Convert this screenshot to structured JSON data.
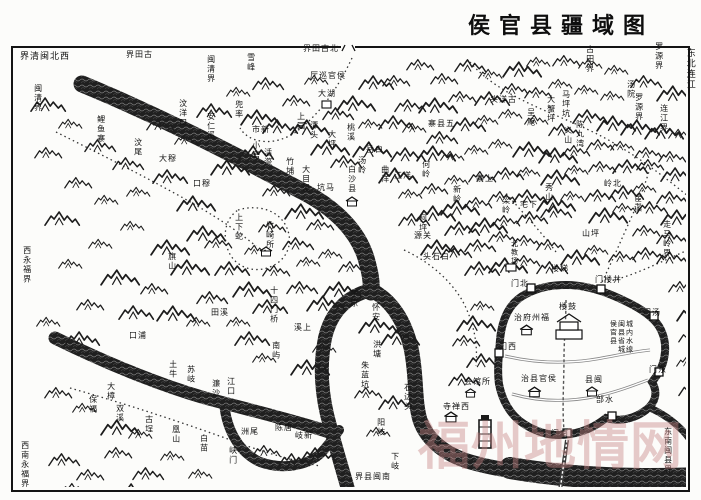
{
  "title": "侯官县疆域图",
  "watermark": "福州地情网",
  "colors": {
    "ink": "#1a1a1a",
    "paper": "#fcfcfa",
    "watermark": "rgba(197,131,131,0.42)"
  },
  "labels": [
    {
      "t": "界清闽北西",
      "x": 20,
      "y": 53,
      "o": "h",
      "fs": 9
    },
    {
      "t": "界田古",
      "x": 126,
      "y": 51,
      "o": "h"
    },
    {
      "t": "闽清界",
      "x": 206,
      "y": 55,
      "o": "v"
    },
    {
      "t": "界田古北",
      "x": 303,
      "y": 45,
      "o": "h"
    },
    {
      "t": "闽清界",
      "x": 33,
      "y": 84,
      "o": "v"
    },
    {
      "t": "古田界",
      "x": 585,
      "y": 45,
      "o": "v"
    },
    {
      "t": "罗源界",
      "x": 654,
      "y": 42,
      "o": "v"
    },
    {
      "t": "东北连江",
      "x": 684,
      "y": 48,
      "o": "v",
      "fs": 9
    },
    {
      "t": "罗源界",
      "x": 634,
      "y": 93,
      "o": "v"
    },
    {
      "t": "连江界",
      "x": 659,
      "y": 104,
      "o": "v"
    },
    {
      "t": "走马岭界",
      "x": 662,
      "y": 220,
      "o": "v"
    },
    {
      "t": "东南闽县界",
      "x": 663,
      "y": 427,
      "o": "v"
    },
    {
      "t": "西永福界",
      "x": 22,
      "y": 246,
      "o": "v"
    },
    {
      "t": "西南永福界",
      "x": 20,
      "y": 441,
      "o": "v"
    },
    {
      "t": "界县闽南",
      "x": 355,
      "y": 473,
      "o": "h"
    },
    {
      "t": "鲤鱼寨",
      "x": 96,
      "y": 115,
      "o": "v"
    },
    {
      "t": "汶尾",
      "x": 133,
      "y": 138,
      "o": "v"
    },
    {
      "t": "汶洋口",
      "x": 178,
      "y": 99,
      "o": "v"
    },
    {
      "t": "安仁溪",
      "x": 206,
      "y": 112,
      "o": "v"
    },
    {
      "t": "雪峰",
      "x": 246,
      "y": 53,
      "o": "v"
    },
    {
      "t": "厅巡官侯",
      "x": 310,
      "y": 72,
      "o": "h"
    },
    {
      "t": "大湖",
      "x": 318,
      "y": 90,
      "o": "h"
    },
    {
      "t": "兜率",
      "x": 234,
      "y": 100,
      "o": "v"
    },
    {
      "t": "市新",
      "x": 252,
      "y": 126,
      "o": "h"
    },
    {
      "t": "上园",
      "x": 296,
      "y": 112,
      "o": "v"
    },
    {
      "t": "潭头",
      "x": 309,
      "y": 121,
      "o": "v"
    },
    {
      "t": "大坪",
      "x": 327,
      "y": 130,
      "o": "v"
    },
    {
      "t": "桃溪",
      "x": 346,
      "y": 123,
      "o": "v"
    },
    {
      "t": "小箬",
      "x": 251,
      "y": 141,
      "o": "v"
    },
    {
      "t": "活漈",
      "x": 263,
      "y": 148,
      "o": "v"
    },
    {
      "t": "竹埔",
      "x": 285,
      "y": 157,
      "o": "v"
    },
    {
      "t": "大目溪",
      "x": 301,
      "y": 165,
      "o": "v"
    },
    {
      "t": "坑马",
      "x": 317,
      "y": 184,
      "o": "h"
    },
    {
      "t": "白沙县",
      "x": 347,
      "y": 165,
      "o": "v"
    },
    {
      "t": "大穆",
      "x": 159,
      "y": 155,
      "o": "h"
    },
    {
      "t": "口穆",
      "x": 193,
      "y": 180,
      "o": "h"
    },
    {
      "t": "旗山",
      "x": 167,
      "y": 252,
      "o": "v"
    },
    {
      "t": "汤岭",
      "x": 357,
      "y": 156,
      "o": "v"
    },
    {
      "t": "岳白",
      "x": 366,
      "y": 146,
      "o": "h"
    },
    {
      "t": "曲洋",
      "x": 380,
      "y": 165,
      "o": "v"
    },
    {
      "t": "江洋",
      "x": 394,
      "y": 172,
      "o": "h"
    },
    {
      "t": "何岭",
      "x": 421,
      "y": 160,
      "o": "v"
    },
    {
      "t": "新岭",
      "x": 452,
      "y": 185,
      "o": "v"
    },
    {
      "t": "源关",
      "x": 414,
      "y": 232,
      "o": "h"
    },
    {
      "t": "头石白",
      "x": 423,
      "y": 253,
      "o": "h"
    },
    {
      "t": "柯坪",
      "x": 418,
      "y": 214,
      "o": "v"
    },
    {
      "t": "头洋古",
      "x": 490,
      "y": 96,
      "o": "h"
    },
    {
      "t": "大蟹坪",
      "x": 546,
      "y": 95,
      "o": "v"
    },
    {
      "t": "马坪坑",
      "x": 561,
      "y": 90,
      "o": "v"
    },
    {
      "t": "呈庵",
      "x": 526,
      "y": 108,
      "o": "v"
    },
    {
      "t": "陈九湾",
      "x": 575,
      "y": 120,
      "o": "v"
    },
    {
      "t": "义山",
      "x": 563,
      "y": 126,
      "o": "v"
    },
    {
      "t": "寨县五",
      "x": 428,
      "y": 120,
      "o": "h"
    },
    {
      "t": "汤院",
      "x": 626,
      "y": 80,
      "o": "v"
    },
    {
      "t": "宦溪",
      "x": 633,
      "y": 194,
      "o": "v"
    },
    {
      "t": "寨上",
      "x": 476,
      "y": 175,
      "o": "h"
    },
    {
      "t": "秀山",
      "x": 544,
      "y": 183,
      "o": "v"
    },
    {
      "t": "宅下",
      "x": 520,
      "y": 201,
      "o": "h"
    },
    {
      "t": "梁岭",
      "x": 501,
      "y": 196,
      "o": "v"
    },
    {
      "t": "岭北",
      "x": 604,
      "y": 180,
      "o": "h"
    },
    {
      "t": "山坪",
      "x": 582,
      "y": 230,
      "o": "h"
    },
    {
      "t": "上下蛇",
      "x": 234,
      "y": 213,
      "o": "v"
    },
    {
      "t": "竹崎所",
      "x": 265,
      "y": 221,
      "o": "v"
    },
    {
      "t": "田溪",
      "x": 211,
      "y": 309,
      "o": "h"
    },
    {
      "t": "十四门桥",
      "x": 269,
      "y": 286,
      "o": "v"
    },
    {
      "t": "溪上",
      "x": 294,
      "y": 324,
      "o": "h"
    },
    {
      "t": "南屿",
      "x": 271,
      "y": 341,
      "o": "v"
    },
    {
      "t": "口浦",
      "x": 129,
      "y": 332,
      "o": "h"
    },
    {
      "t": "土牛",
      "x": 168,
      "y": 360,
      "o": "v"
    },
    {
      "t": "苏岐",
      "x": 186,
      "y": 365,
      "o": "v"
    },
    {
      "t": "濂沙",
      "x": 211,
      "y": 379,
      "o": "v"
    },
    {
      "t": "江口",
      "x": 226,
      "y": 377,
      "o": "v"
    },
    {
      "t": "大樟",
      "x": 106,
      "y": 382,
      "o": "v"
    },
    {
      "t": "保福",
      "x": 88,
      "y": 395,
      "o": "v"
    },
    {
      "t": "双溪",
      "x": 115,
      "y": 404,
      "o": "v"
    },
    {
      "t": "古埕",
      "x": 144,
      "y": 415,
      "o": "v"
    },
    {
      "t": "凰山",
      "x": 171,
      "y": 425,
      "o": "v"
    },
    {
      "t": "白苗",
      "x": 199,
      "y": 434,
      "o": "v"
    },
    {
      "t": "峡门",
      "x": 228,
      "y": 446,
      "o": "v"
    },
    {
      "t": "洲尾",
      "x": 241,
      "y": 428,
      "o": "h"
    },
    {
      "t": "陈唐",
      "x": 275,
      "y": 424,
      "o": "h"
    },
    {
      "t": "岐新",
      "x": 295,
      "y": 432,
      "o": "h"
    },
    {
      "t": "芋原",
      "x": 349,
      "y": 289,
      "o": "v"
    },
    {
      "t": "怀安",
      "x": 371,
      "y": 303,
      "o": "v"
    },
    {
      "t": "洪塘",
      "x": 372,
      "y": 340,
      "o": "v"
    },
    {
      "t": "朱蓝坑",
      "x": 360,
      "y": 361,
      "o": "v"
    },
    {
      "t": "石边头",
      "x": 403,
      "y": 383,
      "o": "v"
    },
    {
      "t": "阳岐",
      "x": 376,
      "y": 418,
      "o": "v"
    },
    {
      "t": "下岐",
      "x": 390,
      "y": 452,
      "o": "v"
    },
    {
      "t": "北教场",
      "x": 510,
      "y": 240,
      "o": "v",
      "fs": 7
    },
    {
      "t": "楼梯",
      "x": 551,
      "y": 265,
      "o": "h"
    },
    {
      "t": "门北",
      "x": 511,
      "y": 280,
      "o": "h"
    },
    {
      "t": "门楼井",
      "x": 595,
      "y": 276,
      "o": "h"
    },
    {
      "t": "门汤",
      "x": 643,
      "y": 309,
      "o": "h"
    },
    {
      "t": "门西",
      "x": 499,
      "y": 343,
      "o": "h"
    },
    {
      "t": "门东",
      "x": 649,
      "y": 366,
      "o": "h"
    },
    {
      "t": "部水",
      "x": 596,
      "y": 396,
      "o": "h"
    },
    {
      "t": "门南",
      "x": 551,
      "y": 430,
      "o": "h"
    },
    {
      "t": "楼鼓",
      "x": 559,
      "y": 303,
      "o": "h"
    },
    {
      "t": "治府州福",
      "x": 514,
      "y": 314,
      "o": "h"
    },
    {
      "t": "治县官侯",
      "x": 521,
      "y": 375,
      "o": "h"
    },
    {
      "t": "县闽",
      "x": 585,
      "y": 376,
      "o": "h"
    },
    {
      "t": "城内水缐",
      "x": 625,
      "y": 320,
      "o": "v",
      "fs": 7
    },
    {
      "t": "闽县省城",
      "x": 617,
      "y": 320,
      "o": "v",
      "fs": 7
    },
    {
      "t": "侯官县",
      "x": 609,
      "y": 320,
      "o": "v",
      "fs": 7
    },
    {
      "t": "寺禅西",
      "x": 443,
      "y": 403,
      "o": "h"
    },
    {
      "t": "会馆所",
      "x": 464,
      "y": 378,
      "o": "h"
    }
  ],
  "mountains": [
    [
      30,
      96
    ],
    [
      58,
      118
    ],
    [
      34,
      146
    ],
    [
      84,
      138
    ],
    [
      112,
      156
    ],
    [
      64,
      176
    ],
    [
      94,
      194
    ],
    [
      126,
      186
    ],
    [
      152,
      168
    ],
    [
      44,
      210
    ],
    [
      120,
      220
    ],
    [
      150,
      238
    ],
    [
      88,
      238
    ],
    [
      58,
      258
    ],
    [
      100,
      268
    ],
    [
      140,
      282
    ],
    [
      170,
      258
    ],
    [
      186,
      224
    ],
    [
      176,
      194
    ],
    [
      204,
      236
    ],
    [
      214,
      260
    ],
    [
      232,
      280
    ],
    [
      196,
      290
    ],
    [
      156,
      304
    ],
    [
      118,
      304
    ],
    [
      76,
      298
    ],
    [
      186,
      316
    ],
    [
      226,
      316
    ],
    [
      252,
      298
    ],
    [
      262,
      264
    ],
    [
      244,
      244
    ],
    [
      258,
      220
    ],
    [
      282,
      236
    ],
    [
      296,
      256
    ],
    [
      286,
      280
    ],
    [
      306,
      294
    ],
    [
      322,
      280
    ],
    [
      318,
      248
    ],
    [
      338,
      260
    ],
    [
      210,
      158
    ],
    [
      238,
      144
    ],
    [
      262,
      184
    ],
    [
      284,
      202
    ],
    [
      306,
      218
    ],
    [
      146,
      118
    ],
    [
      174,
      134
    ],
    [
      196,
      102
    ],
    [
      226,
      86
    ],
    [
      252,
      76
    ],
    [
      282,
      94
    ],
    [
      304,
      74
    ],
    [
      322,
      106
    ],
    [
      290,
      118
    ],
    [
      262,
      118
    ],
    [
      240,
      108
    ],
    [
      310,
      138
    ],
    [
      330,
      154
    ],
    [
      352,
      140
    ],
    [
      358,
      118
    ],
    [
      336,
      94
    ],
    [
      358,
      74
    ],
    [
      382,
      74
    ],
    [
      406,
      58
    ],
    [
      430,
      72
    ],
    [
      454,
      58
    ],
    [
      478,
      68
    ],
    [
      502,
      60
    ],
    [
      526,
      56
    ],
    [
      552,
      54
    ],
    [
      578,
      58
    ],
    [
      604,
      64
    ],
    [
      630,
      74
    ],
    [
      656,
      84
    ],
    [
      600,
      90
    ],
    [
      574,
      84
    ],
    [
      548,
      78
    ],
    [
      524,
      86
    ],
    [
      500,
      82
    ],
    [
      474,
      90
    ],
    [
      448,
      90
    ],
    [
      418,
      96
    ],
    [
      394,
      98
    ],
    [
      378,
      114
    ],
    [
      402,
      122
    ],
    [
      426,
      130
    ],
    [
      450,
      116
    ],
    [
      474,
      114
    ],
    [
      498,
      108
    ],
    [
      524,
      114
    ],
    [
      548,
      122
    ],
    [
      572,
      108
    ],
    [
      596,
      114
    ],
    [
      620,
      118
    ],
    [
      644,
      122
    ],
    [
      668,
      128
    ],
    [
      658,
      150
    ],
    [
      634,
      146
    ],
    [
      610,
      140
    ],
    [
      586,
      138
    ],
    [
      562,
      144
    ],
    [
      538,
      146
    ],
    [
      512,
      140
    ],
    [
      488,
      138
    ],
    [
      464,
      144
    ],
    [
      440,
      150
    ],
    [
      416,
      144
    ],
    [
      390,
      146
    ],
    [
      378,
      166
    ],
    [
      398,
      188
    ],
    [
      420,
      182
    ],
    [
      444,
      174
    ],
    [
      468,
      170
    ],
    [
      492,
      166
    ],
    [
      516,
      166
    ],
    [
      540,
      168
    ],
    [
      564,
      164
    ],
    [
      588,
      160
    ],
    [
      612,
      158
    ],
    [
      636,
      158
    ],
    [
      660,
      166
    ],
    [
      656,
      190
    ],
    [
      632,
      182
    ],
    [
      608,
      184
    ],
    [
      584,
      188
    ],
    [
      560,
      190
    ],
    [
      536,
      194
    ],
    [
      512,
      188
    ],
    [
      488,
      190
    ],
    [
      464,
      196
    ],
    [
      440,
      198
    ],
    [
      416,
      204
    ],
    [
      398,
      212
    ],
    [
      420,
      238
    ],
    [
      444,
      220
    ],
    [
      468,
      216
    ],
    [
      492,
      214
    ],
    [
      516,
      210
    ],
    [
      540,
      204
    ],
    [
      588,
      206
    ],
    [
      612,
      202
    ],
    [
      636,
      200
    ],
    [
      660,
      208
    ],
    [
      656,
      230
    ],
    [
      632,
      224
    ],
    [
      584,
      244
    ],
    [
      560,
      248
    ],
    [
      536,
      238
    ],
    [
      512,
      234
    ],
    [
      488,
      230
    ],
    [
      464,
      238
    ],
    [
      440,
      244
    ],
    [
      464,
      260
    ],
    [
      488,
      256
    ],
    [
      512,
      254
    ],
    [
      536,
      260
    ],
    [
      608,
      250
    ],
    [
      632,
      246
    ],
    [
      656,
      250
    ],
    [
      668,
      280
    ],
    [
      676,
      304
    ],
    [
      678,
      330
    ],
    [
      676,
      356
    ],
    [
      678,
      382
    ],
    [
      452,
      334
    ],
    [
      466,
      352
    ],
    [
      448,
      372
    ],
    [
      470,
      300
    ],
    [
      456,
      314
    ],
    [
      358,
      316
    ],
    [
      380,
      328
    ],
    [
      354,
      386
    ],
    [
      378,
      394
    ],
    [
      366,
      426
    ],
    [
      252,
      444
    ],
    [
      278,
      452
    ],
    [
      300,
      446
    ],
    [
      48,
      452
    ],
    [
      76,
      468
    ],
    [
      104,
      446
    ],
    [
      132,
      466
    ],
    [
      160,
      450
    ],
    [
      188,
      468
    ],
    [
      116,
      482
    ],
    [
      60,
      482
    ],
    [
      36,
      316
    ],
    [
      64,
      330
    ],
    [
      44,
      386
    ],
    [
      72,
      402
    ],
    [
      100,
      418
    ],
    [
      128,
      428
    ],
    [
      234,
      330
    ],
    [
      252,
      352
    ],
    [
      290,
      358
    ],
    [
      312,
      342
    ]
  ]
}
